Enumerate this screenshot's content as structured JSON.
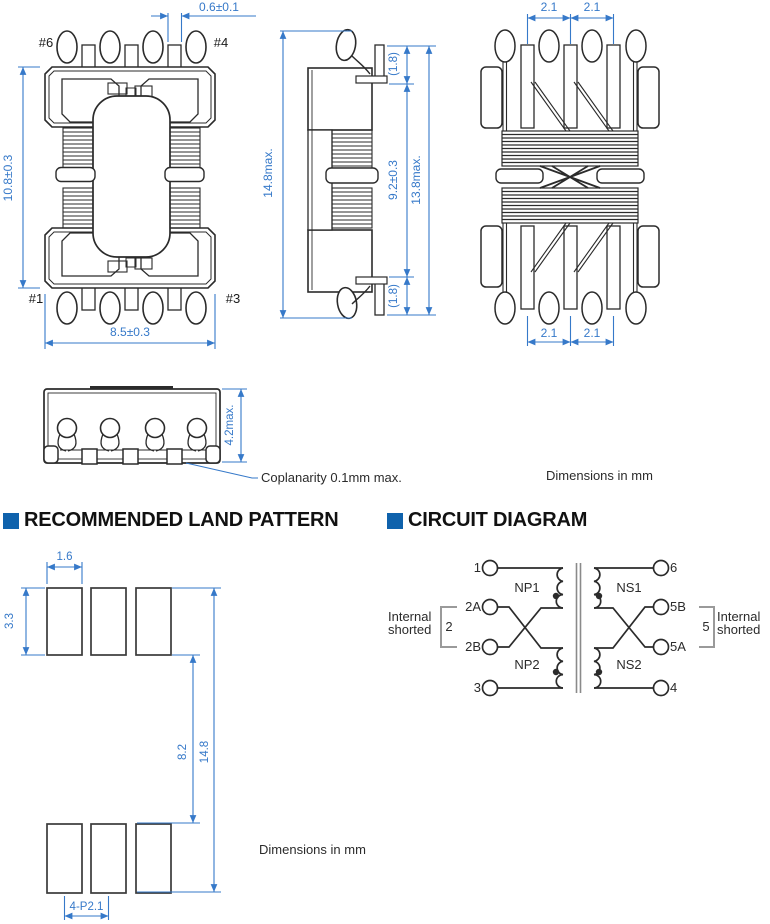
{
  "colors": {
    "dimension_blue": "#3679c9",
    "drawing_line": "#2b2b2b",
    "header_blue": "#0f62ac",
    "core_grey": "#8a8a8a"
  },
  "views": {
    "top_view": {
      "pin_top_left": "#6",
      "pin_top_right": "#4",
      "pin_bottom_left": "#1",
      "pin_bottom_right": "#3",
      "dim_tab_width": "0.6±0.1",
      "dim_height": "10.8±0.3",
      "dim_width": "8.5±0.3"
    },
    "side_view": {
      "dim_total_height": "14.8max.",
      "dim_lead_top": "(1.8)",
      "dim_body": "9.2±0.3",
      "dim_with_leads": "13.8max.",
      "dim_lead_bottom": "(1.8)"
    },
    "back_view": {
      "dim_pitch": [
        "2.1",
        "2.1",
        "2.1",
        "2.1"
      ]
    },
    "front_view": {
      "dim_height": "4.2max.",
      "coplanarity_note": "Coplanarity 0.1mm max."
    },
    "dimensions_note": "Dimensions in mm"
  },
  "land_pattern": {
    "title": "RECOMMENDED LAND PATTERN",
    "dim_pad_width": "1.6",
    "dim_pad_height": "3.3",
    "dim_row_gap": "8.2",
    "dim_total_height": "14.8",
    "dim_pitch": "4-P2.1",
    "dimensions_note": "Dimensions in mm"
  },
  "circuit": {
    "title": "CIRCUIT DIAGRAM",
    "terminals_left": [
      "1",
      "2A",
      "2B",
      "3"
    ],
    "terminals_right": [
      "6",
      "5B",
      "5A",
      "4"
    ],
    "winding_primary_1": "NP1",
    "winding_primary_2": "NP2",
    "winding_secondary_1": "NS1",
    "winding_secondary_2": "NS2",
    "shorted_left": {
      "line1": "Internal",
      "line2": "shorted",
      "pin": "2"
    },
    "shorted_right": {
      "line1": "Internal",
      "line2": "shorted",
      "pin": "5"
    }
  }
}
